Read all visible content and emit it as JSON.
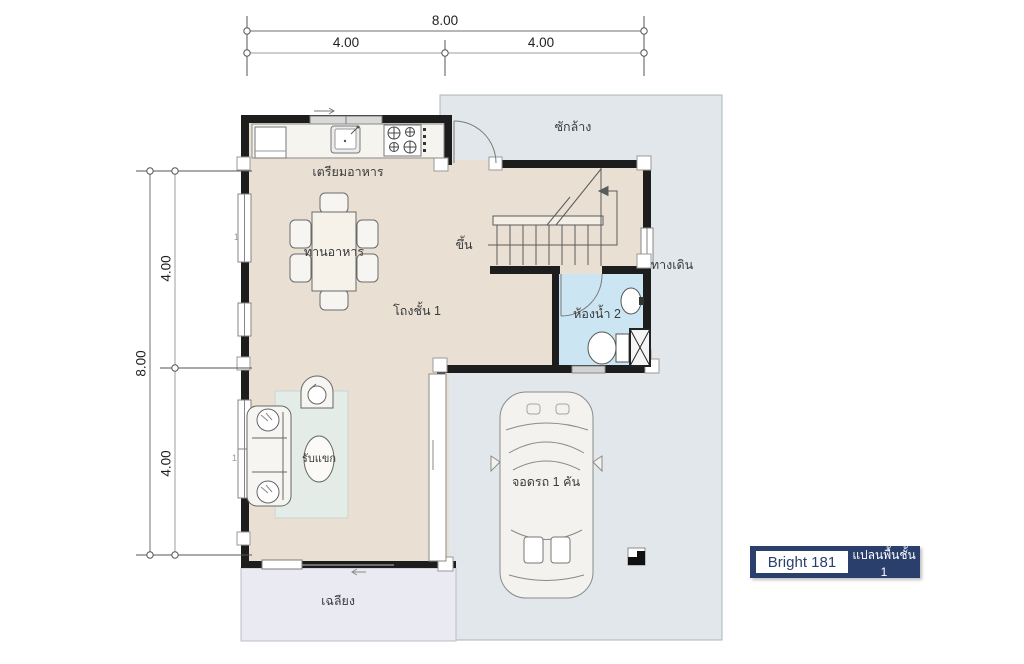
{
  "title_block": {
    "model": "Bright 181",
    "caption": "แปลนพื้นชั้น 1",
    "navy": "#2b3f6d"
  },
  "dimensions": {
    "top": {
      "overall": "8.00",
      "seg1": "4.00",
      "seg2": "4.00"
    },
    "left": {
      "overall": "8.00",
      "seg1": "4.00",
      "seg2": "4.00"
    }
  },
  "rooms": {
    "kitchen": "เตรียมอาหาร",
    "dining": "ทานอาหาร",
    "hall": "โถงชั้น 1",
    "stairs_up": "ขึ้น",
    "laundry": "ซักล้าง",
    "walkway": "ทางเดิน",
    "bathroom": "ห้องน้ำ 2",
    "living": "รับแขก",
    "carpark": "จอดรถ 1 คัน",
    "porch": "เฉลียง"
  },
  "window_tags": {
    "t1": "1",
    "t2": "1"
  },
  "colors": {
    "interior_floor": "#e9e0d3",
    "outdoor_floor": "#e1e7ea",
    "bathroom_floor": "#cbe6f2",
    "porch_floor": "#eaeaf2",
    "rug": "#e4ece8",
    "wall": "#1d1d1d",
    "navy": "#2b3f6d"
  }
}
